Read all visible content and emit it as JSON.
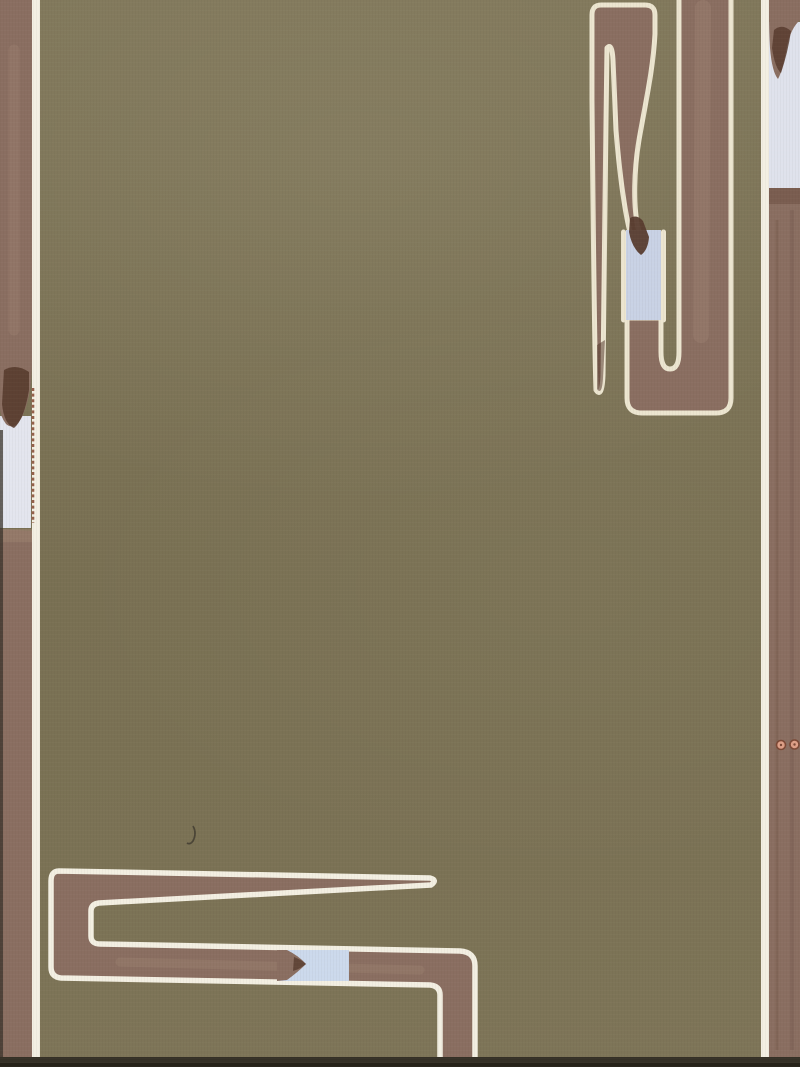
{
  "artwork": {
    "kind": "photograph of an abstract painting on canvas",
    "style": "geometric meander bands outlined in cream on an olive ground",
    "text_content": "none"
  },
  "palette": {
    "olive": "#7b7255",
    "brown": "#8a6e61",
    "brown_light": "#9d8372",
    "brown_dark": "#6e5143",
    "brown_deep": "#583c2f",
    "cream": "#ece5d0",
    "cream_bright": "#f3efe2",
    "blue_left": "#e3e5ee",
    "blue_right": "#dfe2ec",
    "blue_top_right": "#c9d2e5",
    "blue_bottom_left": "#ccd9ec",
    "salmon": "#de9f87",
    "salmon_ring": "#7c4936",
    "stitch": "#95604a",
    "pencil_mark": "#4a4436",
    "edge_shadow": "#353026",
    "edge_shadow_deep": "#262219",
    "left_edge_shadow": "#3a332b",
    "none": "none"
  }
}
